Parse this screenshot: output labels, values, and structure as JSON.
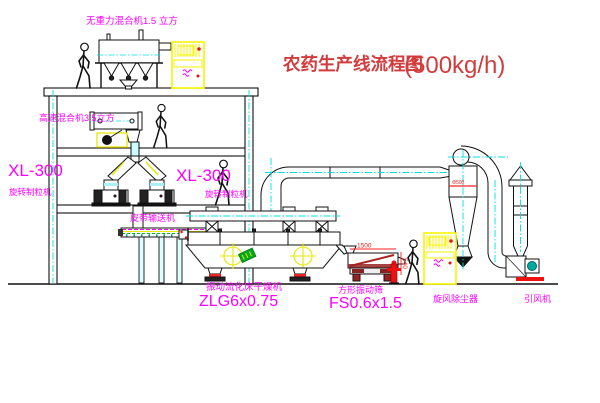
{
  "title": {
    "name": "农药生产线流程图",
    "capacity": "(500kg/h)"
  },
  "equipment_labels": {
    "gravity_mixer": "无重力混合机1.5 立方",
    "high_speed_mixer": "高速混合机3.5立方",
    "granulator_left_model": "XL-300",
    "granulator_left_name": "旋转制粒机",
    "granulator_mid_model": "XL-300",
    "granulator_mid_name": "旋转制粒机",
    "belt_conveyor": "皮带输送机",
    "dryer_name": "振动流化床干燥机",
    "dryer_model": "ZLG6x0.75",
    "sieve_name": "方形振动筛",
    "sieve_model": "FS0.6x1.5",
    "cyclone_collector": "旋风除尘器",
    "induced_draft_fan": "引风机"
  },
  "dimensions": {
    "sieve_length": "1500",
    "sieve_height": "540",
    "cyclone_dia": "Φ500"
  },
  "colors": {
    "label_magenta": "#ff00ff",
    "title_red": "#d23c3c",
    "dimension_red": "#ff2020",
    "centerline_cyan": "#00e0e0",
    "highlight_yellow": "#f5f500",
    "sticker_green": "#00aa22",
    "motor_teal": "#00a9a0",
    "base_red": "#ee1111",
    "line_black": "#111111"
  }
}
